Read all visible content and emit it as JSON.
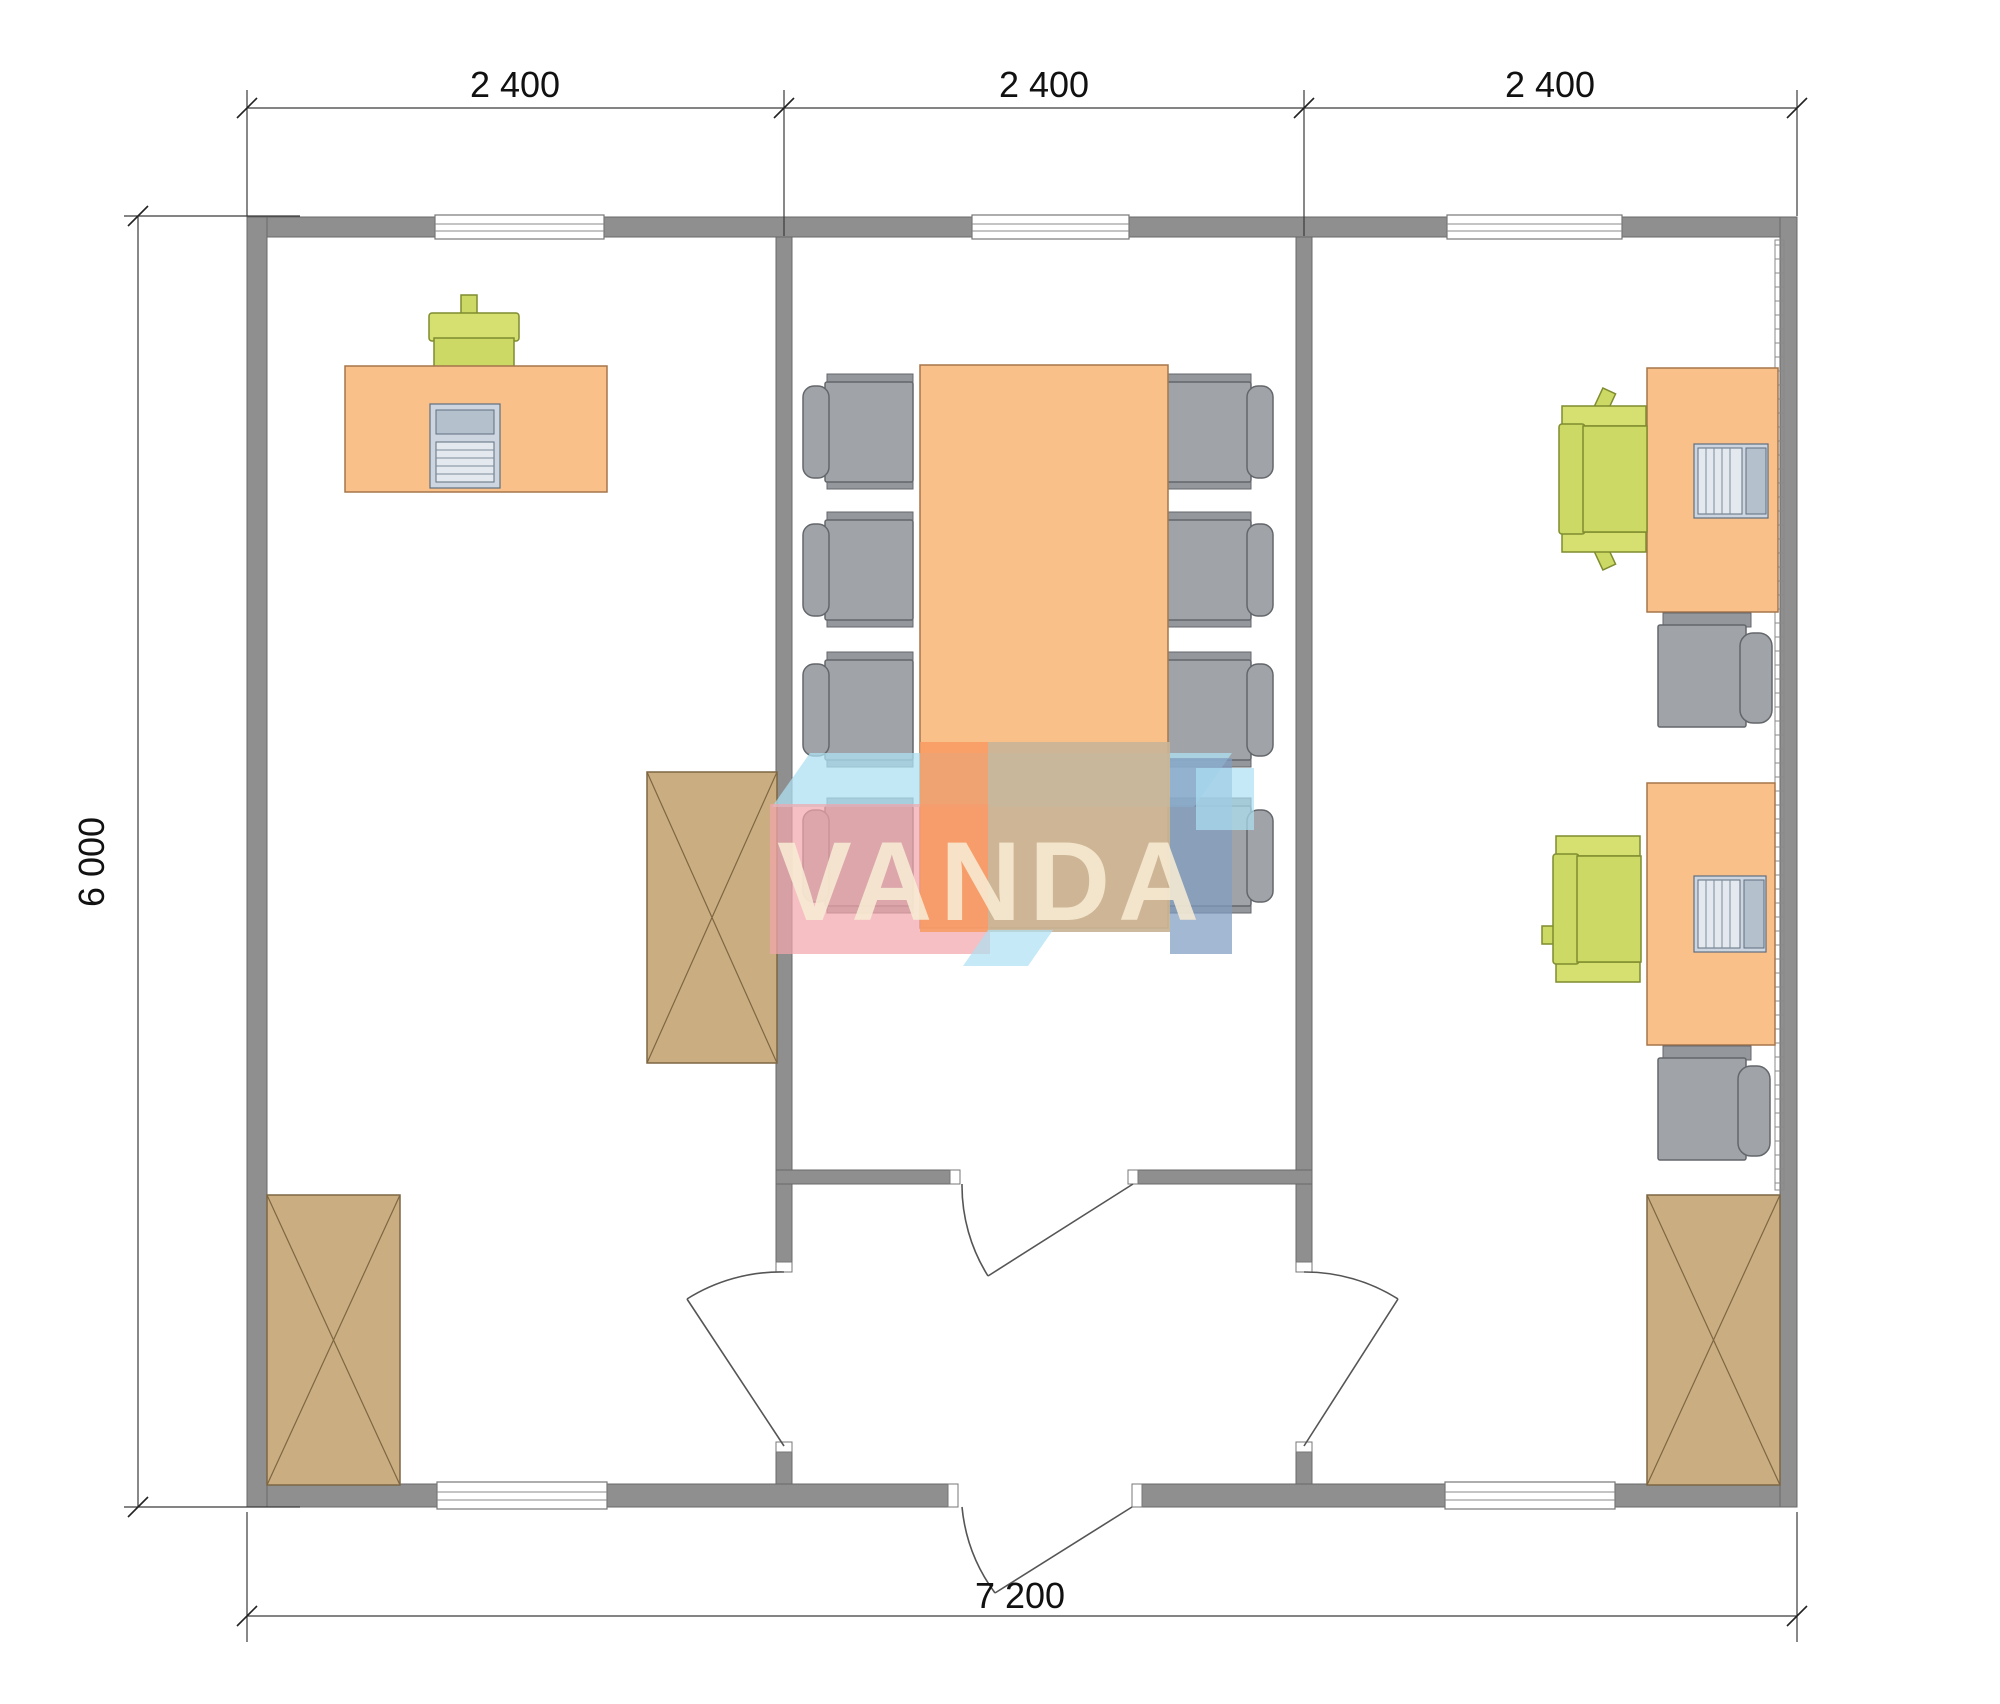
{
  "dimensions": {
    "top_segments": [
      "2 400",
      "2 400",
      "2 400"
    ],
    "left_total": "6 000",
    "bottom_total": "7 200"
  },
  "watermark": {
    "text": "VANDA"
  },
  "colors": {
    "wall": "#8f8f8f",
    "desk": "#fac089",
    "chair_gray": "#a0a4a8",
    "chair_green": "#ccd964",
    "cabinet": "#caad80",
    "wm_blue_light": "#ade0f2",
    "wm_pink": "#f2a6ac",
    "wm_orange": "#f79a61",
    "wm_tan": "#c9b496",
    "wm_slate": "#7f9dc1",
    "wm_text": "#f8ecd4"
  },
  "legend_icons": {
    "rooms": [
      "office-left",
      "meeting-room-center",
      "office-right",
      "entrance-hall"
    ],
    "furniture": [
      "desk",
      "conference-table",
      "office-chair-green",
      "meeting-chair-gray",
      "cabinet-x",
      "desktop-computer",
      "laptop",
      "radiator-strip",
      "window",
      "door-swing"
    ]
  }
}
